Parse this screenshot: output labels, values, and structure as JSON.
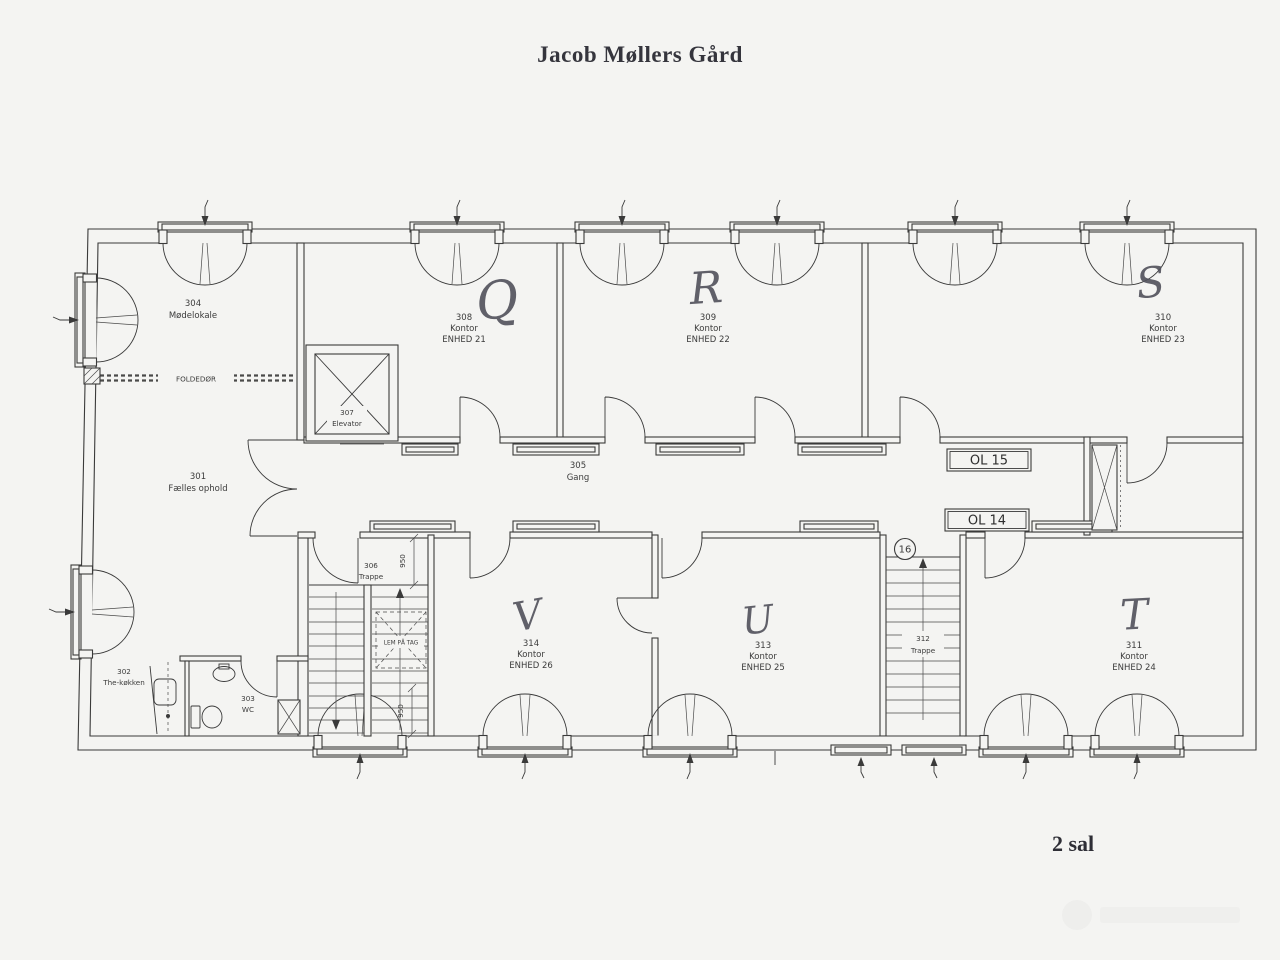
{
  "title": "Jacob Møllers Gård",
  "floor_label": "2 sal",
  "rooms": {
    "r301": {
      "id": "301",
      "name": "Fælles ophold"
    },
    "r302": {
      "id": "302",
      "name": "The-køkken"
    },
    "r303": {
      "id": "303",
      "name": "WC"
    },
    "r304": {
      "id": "304",
      "name": "Mødelokale"
    },
    "r305": {
      "id": "305",
      "name": "Gang"
    },
    "r306": {
      "id": "306",
      "name": "Trappe"
    },
    "r307": {
      "id": "307",
      "name": "Elevator"
    },
    "r308": {
      "id": "308",
      "name": "Kontor",
      "unit": "ENHED 21",
      "letter": "Q"
    },
    "r309": {
      "id": "309",
      "name": "Kontor",
      "unit": "ENHED 22",
      "letter": "R"
    },
    "r310": {
      "id": "310",
      "name": "Kontor",
      "unit": "ENHED 23",
      "letter": "S"
    },
    "r311": {
      "id": "311",
      "name": "Kontor",
      "unit": "ENHED 24",
      "letter": "T"
    },
    "r312": {
      "id": "312",
      "name": "Trappe"
    },
    "r313": {
      "id": "313",
      "name": "Kontor",
      "unit": "ENHED 25",
      "letter": "U"
    },
    "r314": {
      "id": "314",
      "name": "Kontor",
      "unit": "ENHED 26",
      "letter": "V"
    }
  },
  "annotations": {
    "ol15": "OL 15",
    "ol14": "OL 14",
    "node16": "16",
    "folding_door": "FOLDEDØR",
    "roof_hatch": "LEM PÅ TAG",
    "dim_upper": "950",
    "dim_lower": "950"
  }
}
